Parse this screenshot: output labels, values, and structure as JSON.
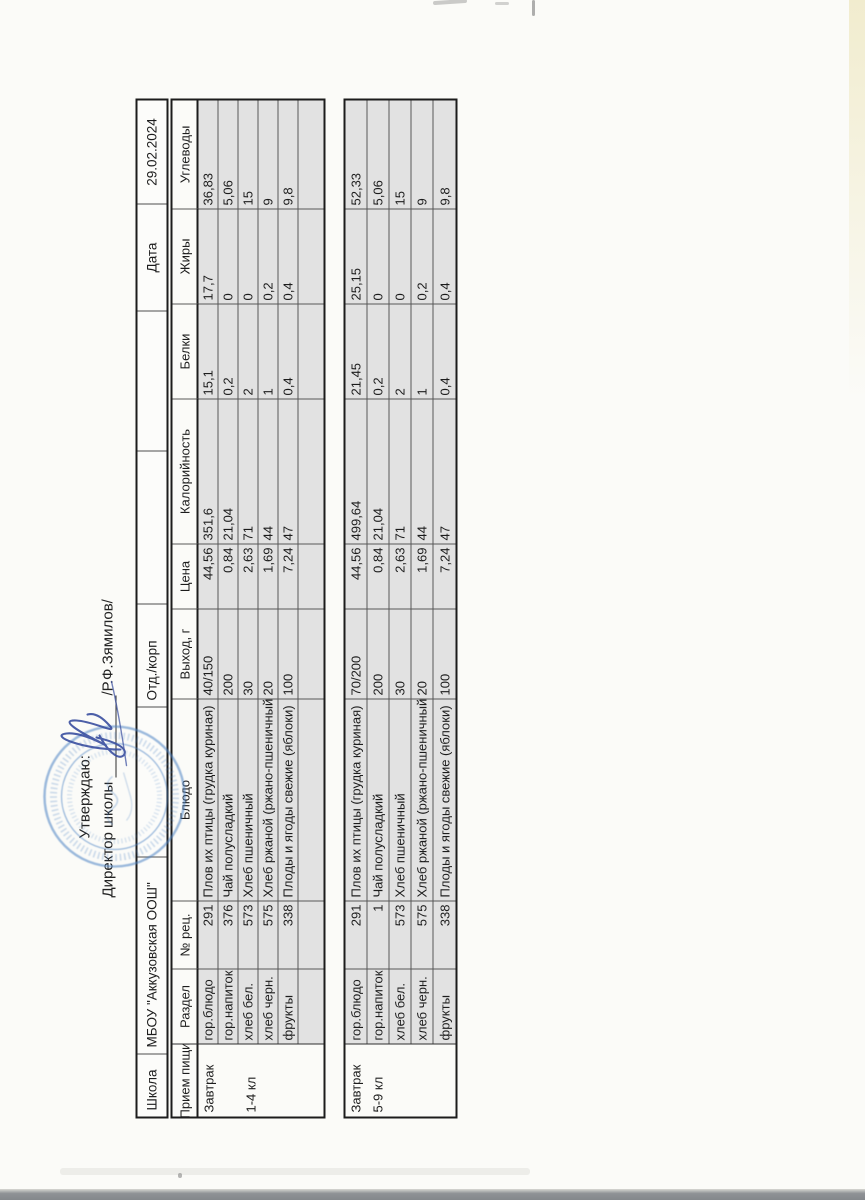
{
  "document": {
    "approval": {
      "line1": "Утверждаю:",
      "line2_prefix": "Директор школы ",
      "line2_suffix": "/Р.Ф.Зямилов/"
    },
    "info_row": {
      "cells": [
        "Школа",
        "МБОУ \"Аккузовская ООШ\"",
        "",
        "Отд./корп",
        "",
        "",
        "Дата",
        "29.02.2024"
      ]
    },
    "columns": [
      "Прием пищи",
      "Раздел",
      "№ рец.",
      "Блюдо",
      "Выход, г",
      "Цена",
      "Калорийность",
      "Белки",
      "Жиры",
      "Углеводы"
    ],
    "groups": [
      {
        "meal": "Завтрак",
        "grade": "1-4 кл",
        "rows": [
          [
            "гор.блюдо",
            "291",
            "Плов их птицы (грудка куриная)",
            "40/150",
            "44,56",
            "351,6",
            "15,1",
            "17,7",
            "36,83"
          ],
          [
            "гор.напиток",
            "376",
            "Чай полусладкий",
            "200",
            "0,84",
            "21,04",
            "0,2",
            "0",
            "5,06"
          ],
          [
            "хлеб бел.",
            "573",
            "Хлеб пшеничный",
            "30",
            "2,63",
            "71",
            "2",
            "0",
            "15"
          ],
          [
            "хлеб черн.",
            "575",
            "Хлеб ржаной (ржано-пшеничный)",
            "20",
            "1,69",
            "44",
            "1",
            "0,2",
            "9"
          ],
          [
            "фрукты",
            "338",
            "Плоды и ягоды свежие (яблоки)",
            "100",
            "7,24",
            "47",
            "0,4",
            "0,4",
            "9,8"
          ],
          [
            "",
            "",
            "",
            "",
            "",
            "",
            "",
            "",
            ""
          ]
        ]
      },
      {
        "meal": "Завтрак",
        "grade": "5-9 кл",
        "rows": [
          [
            "гор.блюдо",
            "291",
            "Плов их птицы (грудка куриная)",
            "70/200",
            "44,56",
            "499,64",
            "21,45",
            "25,15",
            "52,33"
          ],
          [
            "гор.напиток",
            "1",
            "Чай полусладкий",
            "200",
            "0,84",
            "21,04",
            "0,2",
            "0",
            "5,06"
          ],
          [
            "хлеб бел.",
            "573",
            "Хлеб пшеничный",
            "30",
            "2,63",
            "71",
            "2",
            "0",
            "15"
          ],
          [
            "хлеб черн.",
            "575",
            "Хлеб ржаной (ржано-пшеничный)",
            "20",
            "1,69",
            "44",
            "1",
            "0,2",
            "9"
          ],
          [
            "фрукты",
            "338",
            "Плоды и ягоды свежие (яблоки)",
            "100",
            "7,24",
            "47",
            "0,4",
            "0,4",
            "9,8"
          ]
        ]
      }
    ],
    "colors": {
      "cell_fill": "#e2e2e2",
      "stamp_blue": "#4b82c4",
      "signature_blue": "#3a4fa0"
    }
  }
}
